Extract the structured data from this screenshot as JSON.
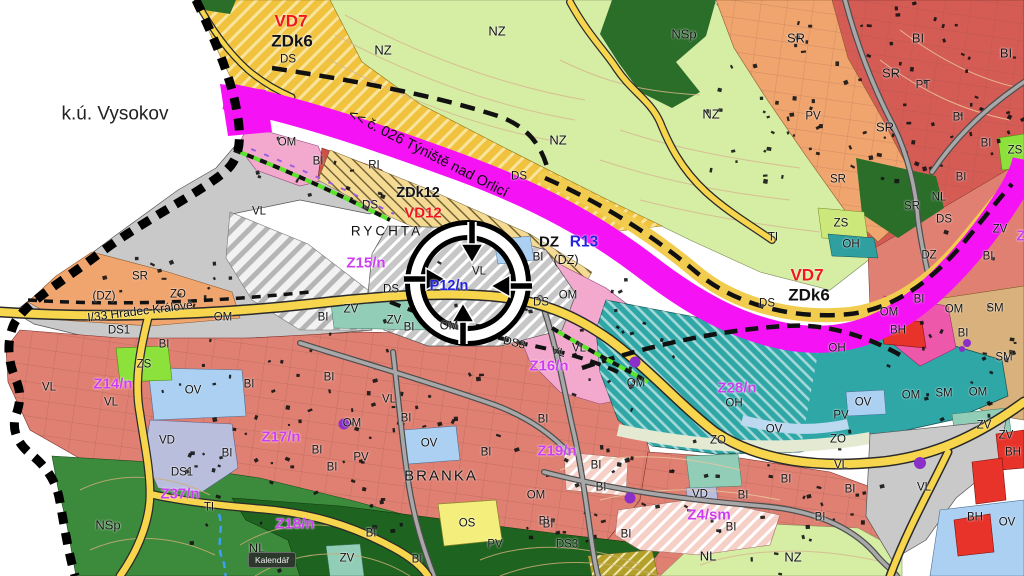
{
  "map": {
    "territory_label": "k.ú. Vysokov",
    "railway_label": "<< č. 026 Týniště nad Orlicí",
    "road_label": "I/33 Hradec Králové",
    "target_marker_label": "P12/n",
    "colors": {
      "corridor_magenta": "#f513f5",
      "road_yellow": "#f7d64e",
      "boundary_black": "#000000",
      "NZ_lightgreen": "#d6eda4",
      "ZDk_gold": "#f1c23d",
      "BI_salmon": "#e08072",
      "BI_darkred": "#cc5247",
      "SR_orange": "#f0a46e",
      "VL_grey": "#c9c9c9",
      "OH_teal": "#2fa7a7",
      "OM_pink": "#f2a9cd",
      "OM_brightpink": "#ee58aa",
      "OV_lightblue": "#abd0f2",
      "VD_lavender": "#b9bedd",
      "NL_darkgreen": "#1f6320",
      "NSp_green": "#3c8a3c",
      "ZS_lime": "#8ce13a",
      "OS_yellow": "#f4ef7d",
      "BH_red": "#e8332a",
      "SM_tan": "#d8b17c",
      "ZV_tealgreen": "#92cdb8",
      "label_magenta": "#cf3df2",
      "label_red": "#f21616",
      "label_blue": "#2424e0"
    },
    "labels": [
      [
        "k.ú. Vysokov",
        115,
        114,
        "kv",
        0
      ],
      [
        "<< č. 026 Týniště nad Orlicí",
        428,
        154,
        "lrw",
        27
      ],
      [
        "I/33 Hradec Králové",
        140,
        311,
        "lrd",
        -7
      ],
      [
        "VD7",
        291,
        21,
        "lr",
        0
      ],
      [
        "ZDk6",
        292,
        41,
        "lz",
        0
      ],
      [
        "DS",
        288,
        60,
        "ls",
        0
      ],
      [
        "NZ",
        383,
        50,
        "ln",
        0
      ],
      [
        "NZ",
        497,
        31,
        "ln",
        0
      ],
      [
        "NSp",
        684,
        34,
        "ln",
        0
      ],
      [
        "SR",
        796,
        38,
        "ln",
        0
      ],
      [
        "BI",
        918,
        38,
        "ln",
        0
      ],
      [
        "BI",
        1006,
        53,
        "ln",
        0
      ],
      [
        "SR",
        891,
        73,
        "ln",
        0
      ],
      [
        "PT",
        923,
        86,
        "ls",
        0
      ],
      [
        "NZ",
        711,
        114,
        "ln",
        0
      ],
      [
        "PV",
        813,
        117,
        "ls",
        0
      ],
      [
        "SR",
        885,
        127,
        "ln",
        0
      ],
      [
        "BI",
        958,
        118,
        "ls",
        0
      ],
      [
        "BI",
        986,
        144,
        "ls",
        0
      ],
      [
        "ZS",
        1015,
        151,
        "ls",
        0
      ],
      [
        "NZ",
        558,
        140,
        "ln",
        0
      ],
      [
        "OM",
        287,
        143,
        "ls",
        0
      ],
      [
        "BI",
        318,
        162,
        "ls",
        0
      ],
      [
        "RI",
        374,
        166,
        "ls",
        0
      ],
      [
        "DS",
        519,
        177,
        "ls",
        0
      ],
      [
        "SR",
        838,
        180,
        "ls",
        0
      ],
      [
        "BI",
        961,
        178,
        "ls",
        0
      ],
      [
        "ZDk12",
        418,
        193,
        "lz2",
        0
      ],
      [
        "NL",
        939,
        198,
        "ls",
        0
      ],
      [
        "DS",
        370,
        206,
        "ls",
        0
      ],
      [
        "SR",
        912,
        207,
        "ls",
        0
      ],
      [
        "VD12",
        423,
        213,
        "lr2",
        0
      ],
      [
        "VL",
        259,
        212,
        "ls",
        0
      ],
      [
        "DS",
        944,
        220,
        "ls",
        0
      ],
      [
        "ZS",
        841,
        224,
        "ls",
        0
      ],
      [
        "RYCHTA",
        387,
        231,
        "lp",
        0
      ],
      [
        "ZV",
        1000,
        230,
        "ls",
        0
      ],
      [
        "Z",
        1021,
        236,
        "lm",
        0
      ],
      [
        "TI",
        773,
        238,
        "ls",
        0
      ],
      [
        "DZ",
        549,
        242,
        "lz3",
        0
      ],
      [
        "R13",
        584,
        242,
        "lb",
        0
      ],
      [
        "OH",
        851,
        245,
        "ls",
        0
      ],
      [
        "DZ",
        929,
        256,
        "ls",
        0
      ],
      [
        "BI",
        988,
        257,
        "ls",
        0
      ],
      [
        "(DZ)",
        566,
        260,
        "ln2",
        0
      ],
      [
        "BI",
        538,
        258,
        "ls",
        0
      ],
      [
        "Z15/n",
        366,
        263,
        "lm",
        0
      ],
      [
        "VL",
        479,
        272,
        "ls",
        0
      ],
      [
        "VD7",
        807,
        275,
        "lr",
        0
      ],
      [
        "SR",
        140,
        277,
        "ls",
        0
      ],
      [
        "P12/n",
        449,
        286,
        "lb2",
        0
      ],
      [
        "DS",
        391,
        290,
        "ls",
        0
      ],
      [
        "ZDk6",
        809,
        295,
        "lz",
        0
      ],
      [
        "ZO",
        178,
        295,
        "ls",
        0
      ],
      [
        "(DZ)",
        104,
        297,
        "ls",
        0
      ],
      [
        "OM",
        568,
        296,
        "ls",
        0
      ],
      [
        "BI",
        919,
        300,
        "ls",
        0
      ],
      [
        "DS",
        541,
        303,
        "ls",
        0
      ],
      [
        "DS",
        767,
        304,
        "ls",
        0
      ],
      [
        "ZV",
        351,
        310,
        "ls",
        0
      ],
      [
        "OM",
        889,
        313,
        "ls",
        0
      ],
      [
        "OM",
        954,
        310,
        "ls",
        0
      ],
      [
        "SM",
        995,
        309,
        "ls",
        0
      ],
      [
        "OM",
        223,
        318,
        "ls",
        0
      ],
      [
        "BI",
        323,
        318,
        "ls",
        0
      ],
      [
        "ZV",
        394,
        321,
        "ls",
        0
      ],
      [
        "OM",
        449,
        327,
        "ls",
        0
      ],
      [
        "BI",
        409,
        328,
        "ls",
        0
      ],
      [
        "DS1",
        119,
        331,
        "ls",
        0
      ],
      [
        "BH",
        898,
        331,
        "ls",
        0
      ],
      [
        "BI",
        963,
        334,
        "ls",
        0
      ],
      [
        "BI",
        164,
        345,
        "ls",
        0
      ],
      [
        "DS3",
        514,
        344,
        "ls",
        14
      ],
      [
        "OH",
        837,
        349,
        "ls",
        0
      ],
      [
        "VL",
        579,
        349,
        "ls",
        0
      ],
      [
        "VL",
        558,
        353,
        "ls",
        14
      ],
      [
        "SM",
        1004,
        358,
        "ls",
        0
      ],
      [
        "ZS",
        144,
        365,
        "ls",
        0
      ],
      [
        "Z16/n",
        549,
        366,
        "lm",
        0
      ],
      [
        "OM",
        636,
        384,
        "ls",
        0
      ],
      [
        "Z28/n",
        737,
        388,
        "lm",
        0
      ],
      [
        "Z14/n",
        113,
        384,
        "lm",
        0
      ],
      [
        "VL",
        49,
        388,
        "ls",
        0
      ],
      [
        "OV",
        193,
        391,
        "ls",
        0
      ],
      [
        "SM",
        944,
        394,
        "ls",
        0
      ],
      [
        "OM",
        978,
        393,
        "ls",
        0
      ],
      [
        "OM",
        911,
        396,
        "ls",
        0
      ],
      [
        "BI",
        249,
        385,
        "ls",
        0
      ],
      [
        "BI",
        329,
        378,
        "ls",
        0
      ],
      [
        "VL",
        389,
        400,
        "ls",
        0
      ],
      [
        "VL",
        111,
        403,
        "ls",
        0
      ],
      [
        "OH",
        734,
        404,
        "ls",
        0
      ],
      [
        "OV",
        863,
        403,
        "ls",
        0
      ],
      [
        "PV",
        841,
        416,
        "ls",
        0
      ],
      [
        "BI",
        406,
        419,
        "ls",
        0
      ],
      [
        "BI",
        543,
        420,
        "ls",
        0
      ],
      [
        "OM",
        352,
        424,
        "ls",
        0
      ],
      [
        "ZV",
        984,
        426,
        "ls",
        0
      ],
      [
        "OV",
        774,
        430,
        "ls",
        0
      ],
      [
        "ZO",
        718,
        441,
        "ls",
        0
      ],
      [
        "ZO",
        838,
        440,
        "ls",
        0
      ],
      [
        "ZV",
        1006,
        436,
        "ls",
        0
      ],
      [
        "VD",
        167,
        441,
        "ls",
        0
      ],
      [
        "OV",
        429,
        444,
        "ls",
        0
      ],
      [
        "Z17/n",
        281,
        437,
        "lm",
        0
      ],
      [
        "BI",
        227,
        454,
        "ls",
        0
      ],
      [
        "Z19/n",
        557,
        451,
        "lm",
        0
      ],
      [
        "BI",
        317,
        451,
        "ls",
        0
      ],
      [
        "PV",
        361,
        458,
        "ls",
        0
      ],
      [
        "BH",
        1013,
        453,
        "ls",
        0
      ],
      [
        "BI",
        486,
        453,
        "ls",
        0
      ],
      [
        "BI",
        332,
        468,
        "ls",
        0
      ],
      [
        "VL",
        841,
        466,
        "ls",
        0
      ],
      [
        "BI",
        596,
        466,
        "ls",
        0
      ],
      [
        "BRANKA",
        441,
        476,
        "lP",
        0
      ],
      [
        "DS1",
        182,
        473,
        "ls",
        0
      ],
      [
        "BI",
        786,
        480,
        "ls",
        0
      ],
      [
        "VL",
        924,
        488,
        "ls",
        0
      ],
      [
        "BI",
        601,
        488,
        "ls",
        0
      ],
      [
        "BI",
        850,
        490,
        "ls",
        0
      ],
      [
        "Z37/n",
        180,
        494,
        "lm",
        0
      ],
      [
        "VD",
        700,
        495,
        "ls",
        0
      ],
      [
        "BI",
        743,
        496,
        "ls",
        0
      ],
      [
        "OM",
        536,
        496,
        "ls",
        0
      ],
      [
        "TI",
        209,
        508,
        "ls",
        0
      ],
      [
        "Z4/sm",
        709,
        515,
        "lm",
        0
      ],
      [
        "BI",
        820,
        518,
        "ls",
        0
      ],
      [
        "BH",
        975,
        518,
        "ls",
        0
      ],
      [
        "OV",
        1007,
        523,
        "ls",
        0
      ],
      [
        "BI",
        544,
        522,
        "ls",
        0
      ],
      [
        "OS",
        467,
        524,
        "ls",
        0
      ],
      [
        "Z18/n",
        295,
        524,
        "lm",
        0
      ],
      [
        "NSp",
        108,
        525,
        "ln",
        0
      ],
      [
        "BI",
        548,
        525,
        "ls",
        0
      ],
      [
        "BI",
        626,
        535,
        "ls",
        0
      ],
      [
        "BI",
        731,
        528,
        "ls",
        0
      ],
      [
        "BI",
        371,
        534,
        "ls",
        0
      ],
      [
        "PV",
        495,
        545,
        "ls",
        0
      ],
      [
        "DS3",
        567,
        545,
        "ls",
        0
      ],
      [
        "NL",
        257,
        548,
        "ln",
        0
      ],
      [
        "NL",
        708,
        556,
        "ln",
        0
      ],
      [
        "NZ",
        793,
        557,
        "ln",
        0
      ],
      [
        "ZV",
        347,
        559,
        "ls",
        0
      ],
      [
        "BI",
        417,
        560,
        "ls",
        0
      ]
    ]
  },
  "tooltip": {
    "label": "Kalendář"
  }
}
